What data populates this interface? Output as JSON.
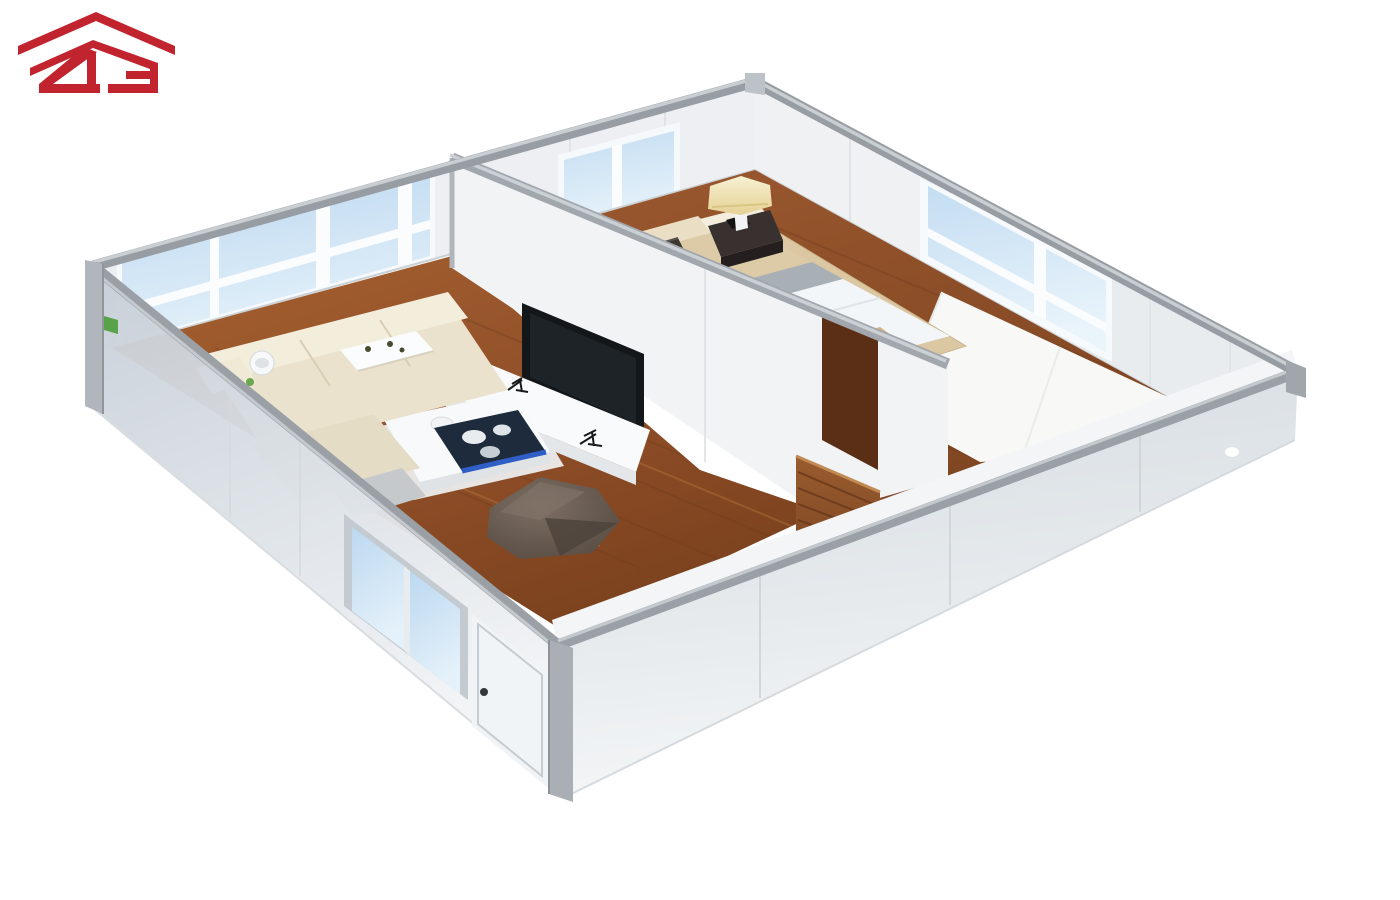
{
  "meta": {
    "description": "3D isometric cutaway rendering of a prefab flat-pack container house interior with living room and bedroom",
    "background_color": "#ffffff"
  },
  "logo": {
    "text": "2G",
    "style": "red roof chevron above stylized 2G letters",
    "color": "#C2242F"
  },
  "scene": {
    "render_type": "isometric-cutaway",
    "structure": {
      "frame_color": "#979DA3",
      "exterior_wall_color": "#D9DFE5",
      "interior_wall_color": "#EFF1F3",
      "floor_wood_color": "#8E4E26",
      "window_glass_color": "#C8E0F4",
      "corner_sticker_color": "#58A24A"
    },
    "rooms": [
      {
        "name": "living-room",
        "furniture": [
          "corner-sofa",
          "sofa-serving-tray",
          "white-cup",
          "coffee-table",
          "blue-serving-tablet",
          "bean-bag",
          "tv-console",
          "recessed-tv",
          "console-decor",
          "white-rug"
        ]
      },
      {
        "name": "bedroom",
        "furniture": [
          "double-bed",
          "pillows",
          "gray-throw-band",
          "dark-cushion",
          "foot-bench",
          "nightstand",
          "table-lamp",
          "beige-rug"
        ]
      },
      {
        "name": "bathroom-corner",
        "furniture": []
      }
    ],
    "openings": [
      "living-room-panorama-window",
      "bedroom-back-window",
      "bedroom-side-window",
      "front-sliding-window",
      "entry-door",
      "open-interior-wood-door"
    ],
    "colors": {
      "sofa": "#EAE2CD",
      "bed_blanket": "#DCCBA6",
      "bed_duvet": "#F3F6F9",
      "lamp_shade": "#F1E7C2",
      "nightstand": "#383130",
      "interior_door_wood": "#9A5C2E",
      "bean_bag": "#6B5F55",
      "tray_blue_accent": "#2F5FC6",
      "tv_screen": "#14171A"
    }
  }
}
